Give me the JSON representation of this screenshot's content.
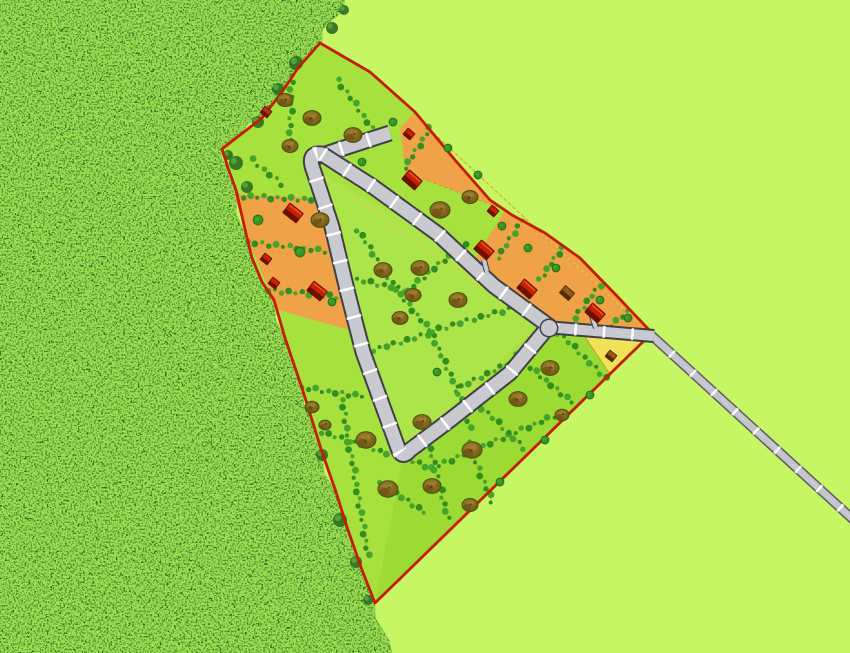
{
  "scene": {
    "description": "Aerial site plan of a small housing subdivision: a red-outlined triangular development parcel carved out of a dense forest on the left, flat light-green fields on the right, an internal loop road with lot-frontage ticks, orange and yellow building lots, red and brown houses, trees and hedgerows, and an access road running to the lower-right edge."
  },
  "canvas": {
    "w": 850,
    "h": 653
  },
  "palette": {
    "field": "#c6f663",
    "forest_base": "#2a6e22",
    "forest_mid": "#55a233",
    "forest_light": "#9fdc52",
    "lime": "#a6e13e",
    "lime_inner": "#abe549",
    "lime_band": "#9cda34",
    "orange": "#f0a249",
    "yellow": "#f2e258",
    "boundary_red": "#c51d00",
    "road_casing": "#3f4048",
    "road_fill": "#c9cacf",
    "road_tick": "#ffffff",
    "access_casing": "#5d5d66",
    "access_fill": "#c4c5cb",
    "hedge_dark": "#2f8f1f",
    "hedge_light": "#43a52c",
    "parcel_line": "#c89428",
    "setback": "#e8cc52",
    "tree_hi": "#a08030",
    "tree_lo": "#6e5414",
    "tree_dot": "#574208",
    "tree_stroke": "#45510a",
    "bush": "#379324",
    "bush_stroke": "#1c6410",
    "house_red": "#c62100",
    "house_red_dark": "#6e1000",
    "house_red_hi": "#f0502e",
    "house_brown": "#96591c",
    "house_brown_dark": "#4e2c08",
    "house_rust": "#a83414"
  },
  "forest": {
    "edge": [
      [
        345,
        0
      ],
      [
        332,
        20
      ],
      [
        322,
        43
      ],
      [
        298,
        68
      ],
      [
        282,
        92
      ],
      [
        262,
        118
      ],
      [
        240,
        135
      ],
      [
        222,
        149
      ],
      [
        228,
        168
      ],
      [
        236,
        190
      ],
      [
        247,
        238
      ],
      [
        252,
        258
      ],
      [
        262,
        282
      ],
      [
        274,
        300
      ],
      [
        285,
        338
      ],
      [
        302,
        388
      ],
      [
        312,
        420
      ],
      [
        322,
        452
      ],
      [
        336,
        492
      ],
      [
        348,
        530
      ],
      [
        362,
        570
      ],
      [
        375,
        603
      ],
      [
        383,
        630
      ],
      [
        392,
        653
      ]
    ],
    "close": [
      [
        0,
        653
      ],
      [
        0,
        0
      ]
    ],
    "clumps": [
      [
        236,
        163,
        7
      ],
      [
        247,
        187,
        6
      ],
      [
        296,
        63,
        7
      ],
      [
        278,
        89,
        6
      ],
      [
        258,
        122,
        6
      ],
      [
        228,
        155,
        5
      ],
      [
        322,
        455,
        6
      ],
      [
        340,
        520,
        7
      ],
      [
        356,
        562,
        6
      ],
      [
        332,
        28,
        6
      ],
      [
        344,
        10,
        5
      ],
      [
        368,
        600,
        5
      ]
    ]
  },
  "boundary": {
    "outline": [
      [
        320,
        43
      ],
      [
        298,
        68
      ],
      [
        282,
        92
      ],
      [
        262,
        118
      ],
      [
        240,
        135
      ],
      [
        222,
        149
      ],
      [
        228,
        168
      ],
      [
        236,
        190
      ],
      [
        247,
        238
      ],
      [
        252,
        258
      ],
      [
        262,
        282
      ],
      [
        274,
        300
      ],
      [
        285,
        338
      ],
      [
        302,
        388
      ],
      [
        312,
        420
      ],
      [
        322,
        452
      ],
      [
        336,
        492
      ],
      [
        348,
        530
      ],
      [
        362,
        570
      ],
      [
        375,
        603
      ],
      [
        652,
        333
      ],
      [
        615,
        294
      ],
      [
        580,
        258
      ],
      [
        545,
        233
      ],
      [
        512,
        215
      ],
      [
        490,
        200
      ],
      [
        455,
        160
      ],
      [
        415,
        112
      ],
      [
        370,
        72
      ]
    ]
  },
  "regions": {
    "inner_triangle": [
      [
        316,
        170
      ],
      [
        437,
        238
      ],
      [
        540,
        322
      ],
      [
        406,
        452
      ]
    ],
    "se_band": [
      [
        403,
        458
      ],
      [
        545,
        325
      ],
      [
        652,
        333
      ],
      [
        375,
        603
      ]
    ],
    "orange_band": [
      [
        415,
        112
      ],
      [
        455,
        160
      ],
      [
        490,
        200
      ],
      [
        512,
        215
      ],
      [
        545,
        233
      ],
      [
        580,
        258
      ],
      [
        615,
        294
      ],
      [
        652,
        333
      ],
      [
        548,
        326
      ],
      [
        472,
        254
      ],
      [
        437,
        230
      ],
      [
        405,
        170
      ],
      [
        400,
        128
      ]
    ],
    "orange_left": [
      [
        234,
        194
      ],
      [
        318,
        198
      ],
      [
        327,
        228
      ],
      [
        342,
        295
      ],
      [
        350,
        330
      ],
      [
        278,
        310
      ],
      [
        248,
        240
      ]
    ],
    "lime_notch": [
      [
        405,
        172
      ],
      [
        505,
        210
      ],
      [
        476,
        258
      ],
      [
        437,
        233
      ]
    ],
    "yellow_lot": [
      [
        585,
        337
      ],
      [
        648,
        338
      ],
      [
        610,
        374
      ]
    ]
  },
  "roads": {
    "loop_path": "M 322,154 L 372,186 L 438,234 L 494,286 L 549,326 L 510,373 L 450,420 L 410,450 Q 402,460 398,448 L 363,352 L 348,294 L 332,227 L 314,172 Q 306,152 322,154 Z",
    "stub_path": "M 313,158 L 390,133",
    "main_path": "M 546,327 L 654,336",
    "access_path": "M 650,334 L 858,524",
    "junction": {
      "x": 549,
      "y": 328,
      "r": 8
    },
    "loop_w": {
      "casing": 17,
      "fill": 13
    },
    "main_w": {
      "casing": 14,
      "fill": 10
    },
    "access_w": {
      "casing": 10,
      "fill": 7
    },
    "tick_dash": "2.5 26",
    "driveways": [
      [
        596,
        328,
        589,
        307
      ],
      [
        487,
        272,
        484,
        260
      ]
    ]
  },
  "setbacks": [
    "M 320,174 L 435,254 L 530,322",
    "M 528,330 L 450,412 L 407,444",
    "M 398,440 L 360,350 L 328,228",
    "M 428,128 L 648,332"
  ],
  "parcel_lines": [
    [
      405,
      172,
      505,
      210
    ],
    [
      425,
      125,
      645,
      330
    ]
  ],
  "hedges": [
    [
      292,
      75,
      290,
      140
    ],
    [
      338,
      80,
      372,
      128
    ],
    [
      430,
      128,
      405,
      168
    ],
    [
      522,
      220,
      498,
      258
    ],
    [
      562,
      248,
      540,
      280
    ],
    [
      600,
      285,
      575,
      318
    ],
    [
      628,
      312,
      605,
      330
    ],
    [
      248,
      242,
      332,
      252
    ],
    [
      268,
      290,
      350,
      298
    ],
    [
      237,
      196,
      318,
      200
    ],
    [
      358,
      230,
      400,
      295
    ],
    [
      400,
      295,
      430,
      330
    ],
    [
      430,
      330,
      462,
      400
    ],
    [
      462,
      400,
      470,
      428
    ],
    [
      350,
      278,
      405,
      290
    ],
    [
      408,
      290,
      465,
      243
    ],
    [
      432,
      331,
      516,
      307
    ],
    [
      428,
      334,
      366,
      352
    ],
    [
      455,
      390,
      507,
      364
    ],
    [
      342,
      400,
      368,
      555
    ],
    [
      425,
      428,
      448,
      518
    ],
    [
      468,
      442,
      492,
      502
    ],
    [
      322,
      432,
      432,
      468
    ],
    [
      432,
      468,
      554,
      416
    ],
    [
      472,
      398,
      524,
      448
    ],
    [
      515,
      355,
      572,
      402
    ],
    [
      558,
      332,
      606,
      378
    ],
    [
      302,
      388,
      362,
      396
    ],
    [
      380,
      482,
      424,
      512
    ],
    [
      252,
      160,
      282,
      184
    ]
  ],
  "trees": [
    [
      285,
      100,
      8
    ],
    [
      312,
      118,
      9
    ],
    [
      353,
      135,
      9
    ],
    [
      290,
      146,
      8
    ],
    [
      320,
      220,
      9
    ],
    [
      383,
      270,
      9
    ],
    [
      420,
      268,
      9
    ],
    [
      413,
      295,
      8
    ],
    [
      458,
      300,
      9
    ],
    [
      400,
      318,
      8
    ],
    [
      440,
      210,
      10
    ],
    [
      470,
      197,
      8
    ],
    [
      550,
      368,
      9
    ],
    [
      518,
      399,
      9
    ],
    [
      562,
      415,
      7
    ],
    [
      366,
      440,
      10
    ],
    [
      422,
      422,
      9
    ],
    [
      472,
      450,
      10
    ],
    [
      388,
      489,
      10
    ],
    [
      432,
      486,
      9
    ],
    [
      470,
      505,
      8
    ],
    [
      312,
      407,
      7
    ],
    [
      325,
      425,
      6
    ]
  ],
  "bushes": [
    [
      393,
      122,
      4
    ],
    [
      362,
      162,
      4
    ],
    [
      448,
      148,
      4
    ],
    [
      478,
      175,
      4
    ],
    [
      502,
      226,
      4
    ],
    [
      528,
      248,
      4
    ],
    [
      556,
      268,
      4
    ],
    [
      600,
      300,
      4
    ],
    [
      628,
      318,
      4
    ],
    [
      258,
      220,
      5
    ],
    [
      300,
      252,
      5
    ],
    [
      332,
      302,
      4
    ],
    [
      590,
      395,
      4
    ],
    [
      545,
      440,
      4
    ],
    [
      500,
      482,
      4
    ],
    [
      437,
      372,
      4
    ]
  ],
  "houses": [
    {
      "x": 266,
      "y": 112,
      "size": "sm",
      "color": "rust",
      "rot": 38
    },
    {
      "x": 293,
      "y": 213,
      "size": "big",
      "color": "red",
      "rot": 38
    },
    {
      "x": 266,
      "y": 259,
      "size": "sm",
      "color": "red",
      "rot": 38
    },
    {
      "x": 317,
      "y": 291,
      "size": "big",
      "color": "red",
      "rot": 38
    },
    {
      "x": 274,
      "y": 283,
      "size": "sm",
      "color": "red",
      "rot": 38
    },
    {
      "x": 412,
      "y": 180,
      "size": "big",
      "color": "red",
      "rot": 41
    },
    {
      "x": 409,
      "y": 134,
      "size": "sm",
      "color": "red",
      "rot": 41
    },
    {
      "x": 484,
      "y": 250,
      "size": "big",
      "color": "red",
      "rot": 41
    },
    {
      "x": 527,
      "y": 289,
      "size": "big",
      "color": "red",
      "rot": 41
    },
    {
      "x": 595,
      "y": 313,
      "size": "big",
      "color": "red",
      "rot": 41
    },
    {
      "x": 567,
      "y": 293,
      "size": "med",
      "color": "brown",
      "rot": 41
    },
    {
      "x": 493,
      "y": 211,
      "size": "sm",
      "color": "red",
      "rot": 41
    },
    {
      "x": 611,
      "y": 356,
      "size": "sm",
      "color": "brown",
      "rot": 38
    }
  ]
}
